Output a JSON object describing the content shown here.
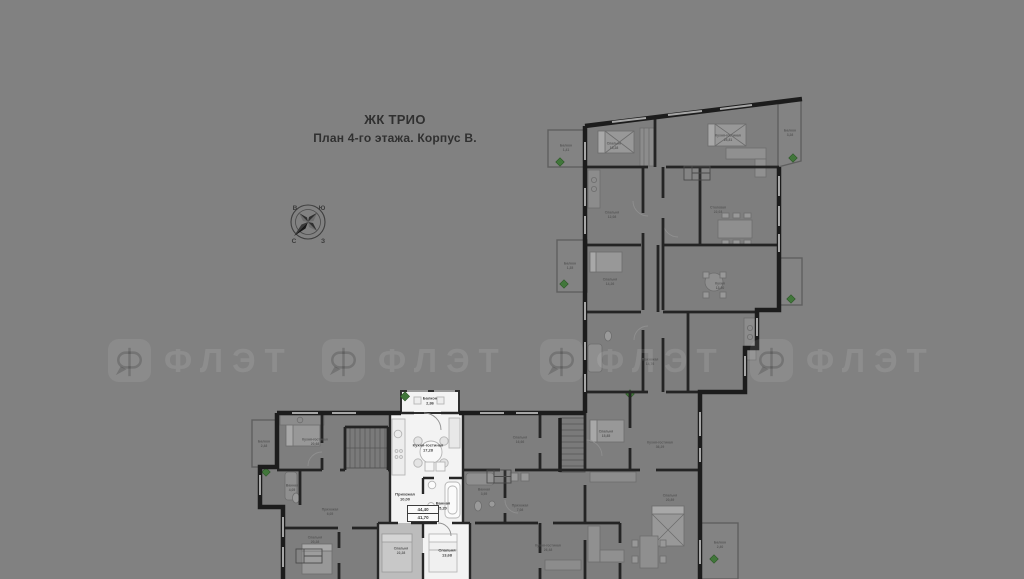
{
  "title": {
    "project": "ЖК ТРИО",
    "subtitle": "План 4-го этажа. Корпус В."
  },
  "compass": {
    "tl": "В",
    "tr": "Ю",
    "bl": "С",
    "br": "З"
  },
  "watermark": {
    "text": "ФЛЭТ",
    "count": 4
  },
  "highlighted_apartment": {
    "stamp": {
      "line1": "44,40",
      "line2": "41,70"
    },
    "rooms": [
      {
        "name": "Балкон",
        "area": "2,86",
        "x": 430,
        "y": 401
      },
      {
        "name": "Кухня-гостиная",
        "area": "17,28",
        "x": 428,
        "y": 448
      },
      {
        "name": "Прихожая",
        "area": "10,00",
        "x": 405,
        "y": 497
      },
      {
        "name": "Ванная",
        "area": "5,20",
        "x": 443,
        "y": 506
      },
      {
        "name": "Спальня",
        "area": "13,68",
        "x": 447,
        "y": 553
      }
    ]
  },
  "plan_rooms": [
    {
      "name": "Балкон",
      "area": "1,41",
      "x": 566,
      "y": 148
    },
    {
      "name": "Спальня",
      "area": "15,28",
      "x": 614,
      "y": 146
    },
    {
      "name": "Кухня-гостиная",
      "area": "25,81",
      "x": 728,
      "y": 138
    },
    {
      "name": "Балкон",
      "area": "3,28",
      "x": 790,
      "y": 133
    },
    {
      "name": "Спальня",
      "area": "12,08",
      "x": 612,
      "y": 215
    },
    {
      "name": "Столовая",
      "area": "22,03",
      "x": 718,
      "y": 210
    },
    {
      "name": "Спальня",
      "area": "14,26",
      "x": 610,
      "y": 282
    },
    {
      "name": "Кухня",
      "area": "13,30",
      "x": 720,
      "y": 286
    },
    {
      "name": "Балкон",
      "area": "1,35",
      "x": 570,
      "y": 266
    },
    {
      "name": "Прихожая",
      "area": "14,76",
      "x": 650,
      "y": 362
    },
    {
      "name": "Спальня",
      "area": "15,85",
      "x": 606,
      "y": 434
    },
    {
      "name": "Кухня-гостиная",
      "area": "36,29",
      "x": 660,
      "y": 445
    },
    {
      "name": "Балкон",
      "area": "2,48",
      "x": 264,
      "y": 444
    },
    {
      "name": "Кухня-гостиная",
      "area": "20,68",
      "x": 315,
      "y": 442
    },
    {
      "name": "Ванная",
      "area": "4,05",
      "x": 292,
      "y": 488
    },
    {
      "name": "Прихожая",
      "area": "6,05",
      "x": 330,
      "y": 512
    },
    {
      "name": "Спальня",
      "area": "20,28",
      "x": 315,
      "y": 540
    },
    {
      "name": "Спальня",
      "area": "22,28",
      "x": 401,
      "y": 551
    },
    {
      "name": "Спальня",
      "area": "16,66",
      "x": 520,
      "y": 440
    },
    {
      "name": "Ванная",
      "area": "3,95",
      "x": 484,
      "y": 492
    },
    {
      "name": "Прихожая",
      "area": "7,08",
      "x": 520,
      "y": 508
    },
    {
      "name": "Кухня-гостиная",
      "area": "26,48",
      "x": 548,
      "y": 548
    },
    {
      "name": "Спальня",
      "area": "20,89",
      "x": 670,
      "y": 498
    },
    {
      "name": "Балкон",
      "area": "2,40",
      "x": 720,
      "y": 545
    }
  ],
  "colors": {
    "background": "#818181",
    "walls": "#1c1c1c",
    "room_fill": "#7e7e7e",
    "highlight": "#f3f3f3",
    "plant": "#41763a",
    "text_dark": "#303030"
  }
}
